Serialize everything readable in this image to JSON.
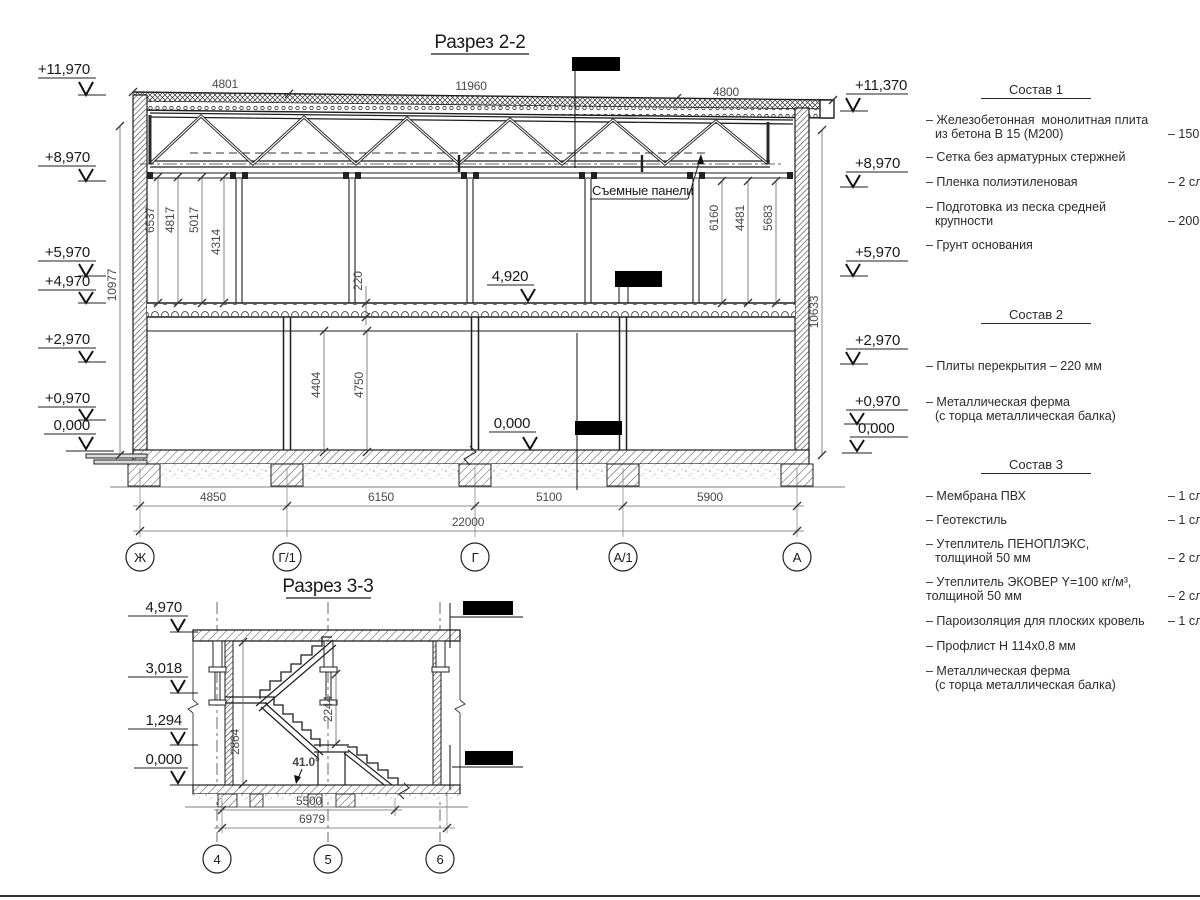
{
  "section22": {
    "title": "Разрез 2-2",
    "labels": {
      "panels": "Съемные панели",
      "mid_floor": "4,920",
      "mid_zero": "0,000"
    },
    "elev_left": [
      "+11,970",
      "+8,970",
      "+5,970",
      "+4,970",
      "+2,970",
      "+0,970",
      "0,000"
    ],
    "elev_right": [
      "+11,370",
      "+8,970",
      "+5,970",
      "+2,970",
      "+0,970",
      "0,000"
    ],
    "dims_top": [
      "4801",
      "11960",
      "4800"
    ],
    "dim_wall_left": "10977",
    "dim_wall_right": "10633",
    "dims_upper_left": [
      "6537",
      "4817",
      "5017",
      "4314"
    ],
    "dims_upper_right": [
      "6160",
      "4481",
      "5683"
    ],
    "dim_slab": "220",
    "dims_lower": [
      "4404",
      "4750"
    ],
    "dims_bottom": [
      "4850",
      "6150",
      "5100",
      "5900"
    ],
    "dim_total": "22000",
    "axes": [
      "Ж",
      "Г/1",
      "Г",
      "А/1",
      "А"
    ]
  },
  "section33": {
    "title": "Разрез 3-3",
    "elev_left": [
      "4,970",
      "3,018",
      "1,294",
      "0,000"
    ],
    "dim_v1": "2864",
    "dim_v2": "2244",
    "angle": "41.0°",
    "dim_b1": "5500",
    "dim_b2": "6979",
    "axes": [
      "4",
      "5",
      "6"
    ]
  },
  "specs": [
    {
      "title": "Состав 1",
      "items": [
        {
          "l1": "– Железобетонная  монолитная плита",
          "l2": "из бетона В 15 (М200)",
          "qty": "– 150 мм"
        },
        {
          "l1": "– Сетка без арматурных стержней",
          "l2": "",
          "qty": ""
        },
        {
          "l1": "– Пленка полиэтиленовая",
          "l2": "",
          "qty": "– 2 слоя"
        },
        {
          "l1": "– Подготовка из песка средней",
          "l2": "крупности",
          "qty": "– 200 мм"
        },
        {
          "l1": "– Грунт основания",
          "l2": "",
          "qty": ""
        }
      ]
    },
    {
      "title": "Состав 2",
      "items": [
        {
          "l1": "– Плиты перекрытия – 220 мм",
          "l2": "",
          "qty": ""
        },
        {
          "l1": "– Металлическая ферма",
          "l2": "(с торца металлическая балка)",
          "qty": ""
        }
      ]
    },
    {
      "title": "Состав 3",
      "items": [
        {
          "l1": "– Мембрана ПВХ",
          "l2": "",
          "qty": "– 1 слой"
        },
        {
          "l1": "– Геотекстиль",
          "l2": "",
          "qty": "– 1 слой"
        },
        {
          "l1": "– Утеплитель ПЕНОПЛЭКС,",
          "l2": "толщиной 50 мм",
          "qty": "– 2 слоя"
        },
        {
          "l1": "– Утеплитель ЭКОВЕР Y=100 кг/м³,",
          "l2": "толщиной 50 мм",
          "qty": "– 2 слоя"
        },
        {
          "l1": "– Пароизоляция для плоских кровель",
          "l2": "",
          "qty": "– 1 слой"
        },
        {
          "l1": "– Профлист Н 114х0.8 мм",
          "l2": "",
          "qty": ""
        },
        {
          "l1": "– Металлическая ферма",
          "l2": "(с торца металлическая балка)",
          "qty": ""
        }
      ]
    }
  ]
}
